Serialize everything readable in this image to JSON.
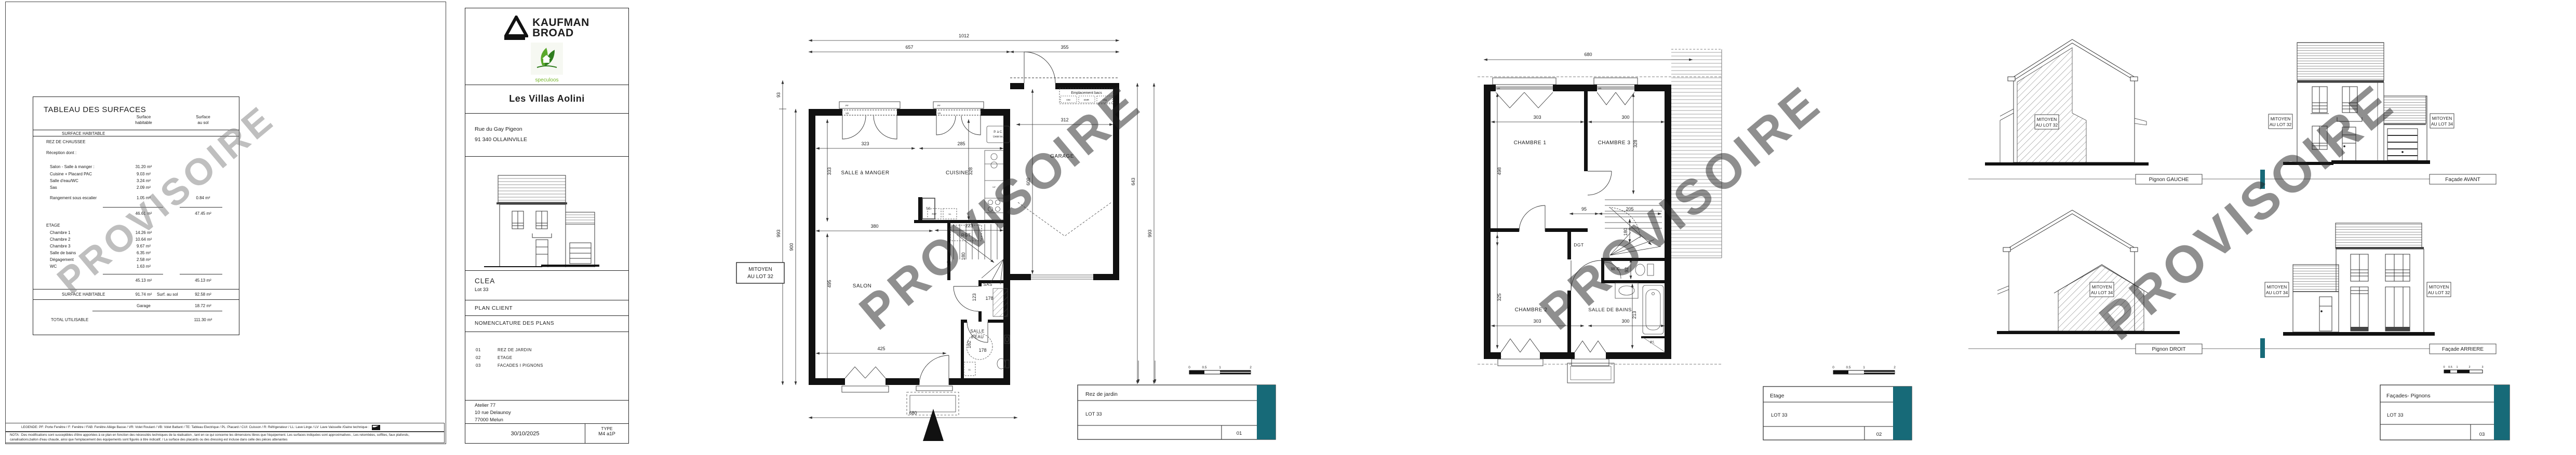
{
  "watermark": "PROVISOIRE",
  "colors": {
    "teal": "#176a78",
    "watermark": "#8c8c8c"
  },
  "surface_table": {
    "title": "TABLEAU DES SURFACES",
    "col_hab_1": "Surface",
    "col_hab_2": "habitable",
    "col_sol_1": "Surface",
    "col_sol_2": "au sol",
    "band1": "SURFACE HABITABLE",
    "rdc_title": "REZ DE CHAUSSEE",
    "rdc_subtitle": "Réception dont :",
    "rdc_rows": [
      {
        "label": "Salon - Salle à manger :",
        "hab": "31.20 m²",
        "sol": ""
      },
      {
        "label": "Cuisine + Placard PAC",
        "hab": "9.03 m²",
        "sol": ""
      },
      {
        "label": "Salle d'eau/WC",
        "hab": "3.24 m²",
        "sol": ""
      },
      {
        "label": "Sas",
        "hab": "2.09 m²",
        "sol": ""
      },
      {
        "label": "Rangement sous escalier",
        "hab": "1.05 m²",
        "sol": "0.84 m²"
      }
    ],
    "rdc_total_hab": "46.61 m²",
    "rdc_total_sol": "47.45 m²",
    "etage_title": "ETAGE",
    "etage_rows": [
      {
        "label": "Chambre 1",
        "hab": "14.26 m²"
      },
      {
        "label": "Chambre 2",
        "hab": "10.64 m²"
      },
      {
        "label": "Chambre 3",
        "hab": "9.67 m²"
      },
      {
        "label": "Salle de bains",
        "hab": "6.35 m²"
      },
      {
        "label": "Dégagement",
        "hab": "2.58 m²"
      },
      {
        "label": "WC",
        "hab": "1.63 m²"
      }
    ],
    "etage_total_hab": "45.13 m²",
    "etage_total_sol": "45.13 m²",
    "total_label": "SURFACE HABITABLE",
    "total_hab": "91.74 m²",
    "total_sol_label": "Surf. au sol",
    "total_sol": "92.58 m²",
    "garage_label": "Garage",
    "garage_sol": "18.72 m²",
    "grand_total_label": "TOTAL UTILISABLE",
    "grand_total": "111.30 m²"
  },
  "legend": {
    "text": "LEGENDE: PF: Porte Fenêtre / F: Fenêtre / FAB: Fenêtre Allège Basse / VR: Volet Roulant / VB: Volet Battant / TE: Tableau Electrique / PL: Placard / CUI: Cuisson / R: Réfrigerateur / LL: Lave Linge / LV: Lave Vaisselle /Gaine technique :"
  },
  "nota": {
    "line1": "NOTA : Des modifications sont susceptibles d'être apportées à ce plan en fonction des nécessités techniques de la réalisation , tant en ce qui concerne les dimensions libres que l'équipement. Les surfaces indiquées sont approximatives , Les retombées, soffites, faux plafonds,",
    "line2": "canalisations,ballon d'eau chaude, ainsi que l'emplacement des équipements sont figurés à titre indicatif. / La surface des placards ou des dressing est incluse dans celle des pièces attenantes"
  },
  "title_block": {
    "brand_line1": "KAUFMAN",
    "brand_line2": "BROAD",
    "brand_sub": "speculoos",
    "project": "Les Villas Aolini",
    "address1": "Rue du Gay Pigeon",
    "address2": "91 340 OLLAINVILLE",
    "model": "CLEA",
    "lot": "Lot 33",
    "doc": "PLAN CLIENT",
    "nomenclature_title": "NOMENCLATURE DES PLANS",
    "nomenclature": [
      {
        "num": "01",
        "label": "REZ DE JARDIN"
      },
      {
        "num": "02",
        "label": "ETAGE"
      },
      {
        "num": "03",
        "label": "FACADES I PIGNONS"
      }
    ],
    "office1": "Atelier 77",
    "office2": "10 rue Delaunoy",
    "office3": "77000 Melun",
    "date": "30/10/2025",
    "type_label": "TYPE",
    "type_value": "M4 a1P"
  },
  "ground_floor": {
    "rooms": {
      "salle_a_manger": "SALLE à MANGER",
      "cuisine": "CUISINE",
      "salon": "SALON",
      "garage": "GARAGE",
      "sas": "SAS",
      "salle_eau_1": "SALLE",
      "salle_eau_2": "d'EAU",
      "rgt": "RGT"
    },
    "labels": {
      "mitoyen_1": "MITOYEN",
      "mitoyen_2": "AU LOT 32",
      "emplacement": "Emplacement bacs",
      "om": "OM",
      "emr": "EMR",
      "veg": "Vég",
      "pac_1": "P. à C.",
      "pac_2": "Unité Int.",
      "te": "T.E.",
      "ref": "REF",
      "ll": "LL",
      "lv": "LV",
      "pf": "PF",
      "vr": "VR"
    },
    "dims": {
      "top_total": "1012",
      "top_house": "657",
      "top_garage": "355",
      "offset_front": "93",
      "left_total": "993",
      "left_house": "900",
      "sam_w": "323",
      "sam_h": "333",
      "cui_w": "285",
      "cui_h": "328",
      "salon_w1": "380",
      "salon_h": "495",
      "salon_w2": "425",
      "rgt_w": "223",
      "stair_w": "180",
      "sas_h": "123",
      "sas_w": "178",
      "se_h": "182",
      "se_w": "178",
      "garage_w": "312",
      "garage_h": "600",
      "right_garage": "643",
      "right_total": "993",
      "bottom": "680"
    },
    "title_box": {
      "name": "Rez de jardin",
      "lot": "LOT 33",
      "num": "01"
    },
    "scale": {
      "s0": "0",
      "s05": "0.5",
      "s1": "1",
      "s2": "2"
    }
  },
  "first_floor": {
    "rooms": {
      "ch1": "CHAMBRE 1",
      "ch2": "CHAMBRE 2",
      "ch3": "CHAMBRE 3",
      "sdb": "SALLE DE BAINS",
      "wc": "W.C.",
      "dgt": "DGT",
      "pl": "Pl."
    },
    "dims": {
      "top": "680",
      "ch1_w": "303",
      "ch3_w": "300",
      "ch1_h": "498",
      "ch3_h": "328",
      "hall_w": "95",
      "stair_w": "205",
      "stair_h": "180",
      "wc_h": "92",
      "ch2_h": "325",
      "ch2_w": "303",
      "sdb_w": "300",
      "sdb_h": "213"
    },
    "labels": {
      "vr": "VR",
      "f": "F"
    },
    "title_box": {
      "name": "Etage",
      "lot": "LOT 33",
      "num": "02"
    },
    "scale": {
      "s0": "0",
      "s05": "0.5",
      "s1": "1",
      "s2": "2"
    }
  },
  "elevations": {
    "pignon_gauche": {
      "label": "Pignon GAUCHE",
      "mit_1": "MITOYEN",
      "mit_2": "AU LOT 32"
    },
    "facade_avant": {
      "label": "Façade AVANT",
      "mitL_1": "MITOYEN",
      "mitL_2": "AU LOT 32",
      "mitR_1": "MITOYEN",
      "mitR_2": "AU LOT 34"
    },
    "pignon_droit": {
      "label": "Pignon DROIT",
      "mit_1": "MITOYEN",
      "mit_2": "AU LOT 34"
    },
    "facade_arriere": {
      "label": "Façade ARRIERE",
      "mitL_1": "MITOYEN",
      "mitL_2": "AU LOT 34",
      "mitR_1": "MITOYEN",
      "mitR_2": "AU LOT 32"
    },
    "title_box": {
      "name": "Façades- Pignons",
      "lot": "LOT 33",
      "num": "03"
    },
    "scale": {
      "s0": "0",
      "s05": "0.5",
      "s1": "1",
      "s2": "2",
      "s3": "3"
    }
  }
}
